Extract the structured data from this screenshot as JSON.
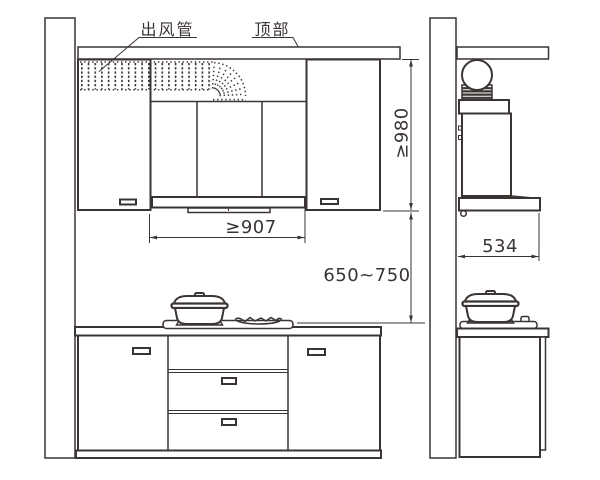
{
  "labels": {
    "duct_label": "出风管",
    "ceiling_label": "顶部"
  },
  "dimensions": {
    "hood_width": "≥907",
    "ceiling_to_hood_bottom": "≥980",
    "hood_to_cooktop": "650~750",
    "hood_depth": "534"
  },
  "colors": {
    "ink": "#3a3432",
    "mortar": "#a3a3a3",
    "background": "#ffffff"
  }
}
